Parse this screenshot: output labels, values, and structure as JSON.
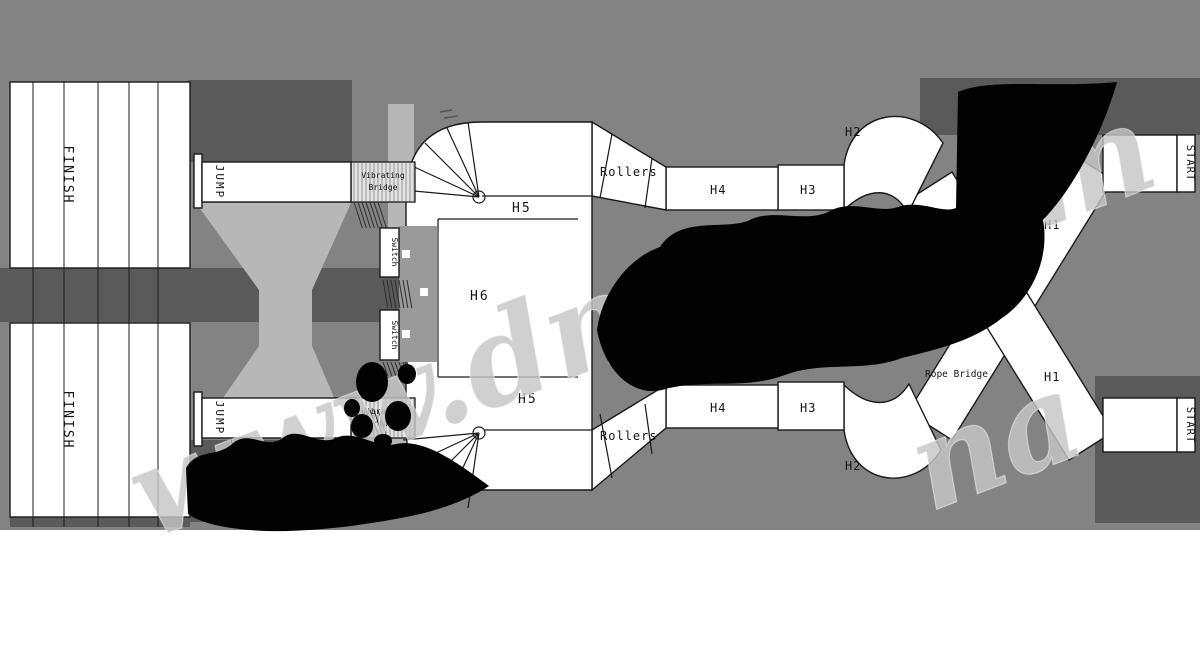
{
  "figure": {
    "type": "obstacle-course-track-plan"
  },
  "colors": {
    "background": "#838383",
    "panel_dark": "#5a5a5a",
    "panel_light": "#b7b7b7",
    "course_fill": "#ffffff",
    "outline": "#1a1a1a",
    "redaction_blob": "#000000",
    "watermark": "#c6c6c6"
  },
  "left": {
    "finish_top": "FINISH",
    "finish_bottom": "FINISH",
    "jump_top": "JUMP",
    "jump_bottom": "JUMP"
  },
  "center": {
    "bridge_top_line1": "Vibrating",
    "bridge_top_line2": "Bridge",
    "bridge_bottom_line1": "Vibrating",
    "bridge_bottom_line2": "Bridge",
    "switch_upper": "Switch",
    "switch_lower": "Switch",
    "h5_top": "H5",
    "h6": "H6",
    "h5_bottom": "H5"
  },
  "top_lane": {
    "rollers": "Rollers",
    "h4": "H4",
    "h3": "H3",
    "h2": "H2",
    "rope_bridge": "Rope Bridge",
    "h1": "H1",
    "start": "START"
  },
  "bottom_lane": {
    "rollers": "Rollers",
    "h4": "H4",
    "h3": "H3",
    "h2": "H2",
    "rope_bridge": "Rope Bridge",
    "h1": "H1",
    "start": "START"
  },
  "watermark": {
    "main": "www.dnat",
    "fragment_right": "m",
    "fragment_lower": "na"
  }
}
